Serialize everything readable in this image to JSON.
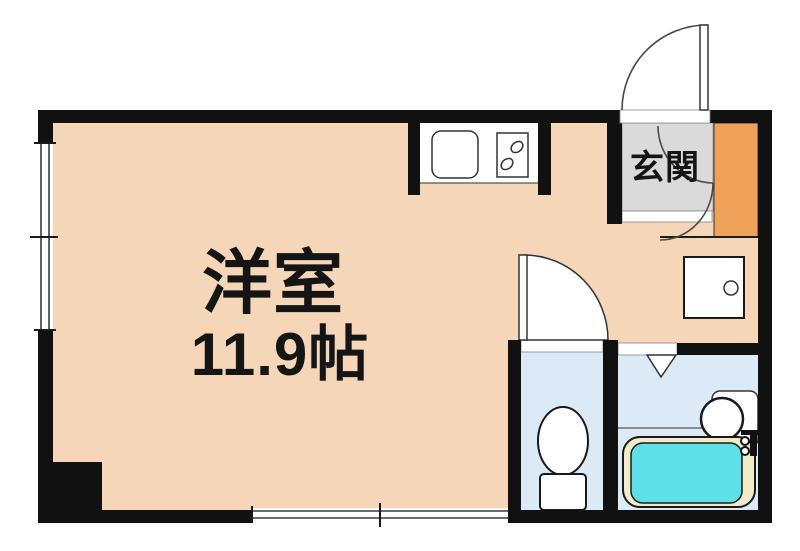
{
  "floorplan": {
    "labels": {
      "main_room": "洋室",
      "main_room_size": "11.9帖",
      "entrance": "玄関"
    },
    "colors": {
      "wall": "#111111",
      "floor": "#f5d6b8",
      "genkan_floor": "#dadadb",
      "entrance_accent": "#f0a158",
      "wet_room_floor": "#dce9f7",
      "bathtub_water": "#5fe0e9",
      "bathtub_rim": "#f0ecca",
      "fixture_fill": "#ffffff"
    }
  }
}
